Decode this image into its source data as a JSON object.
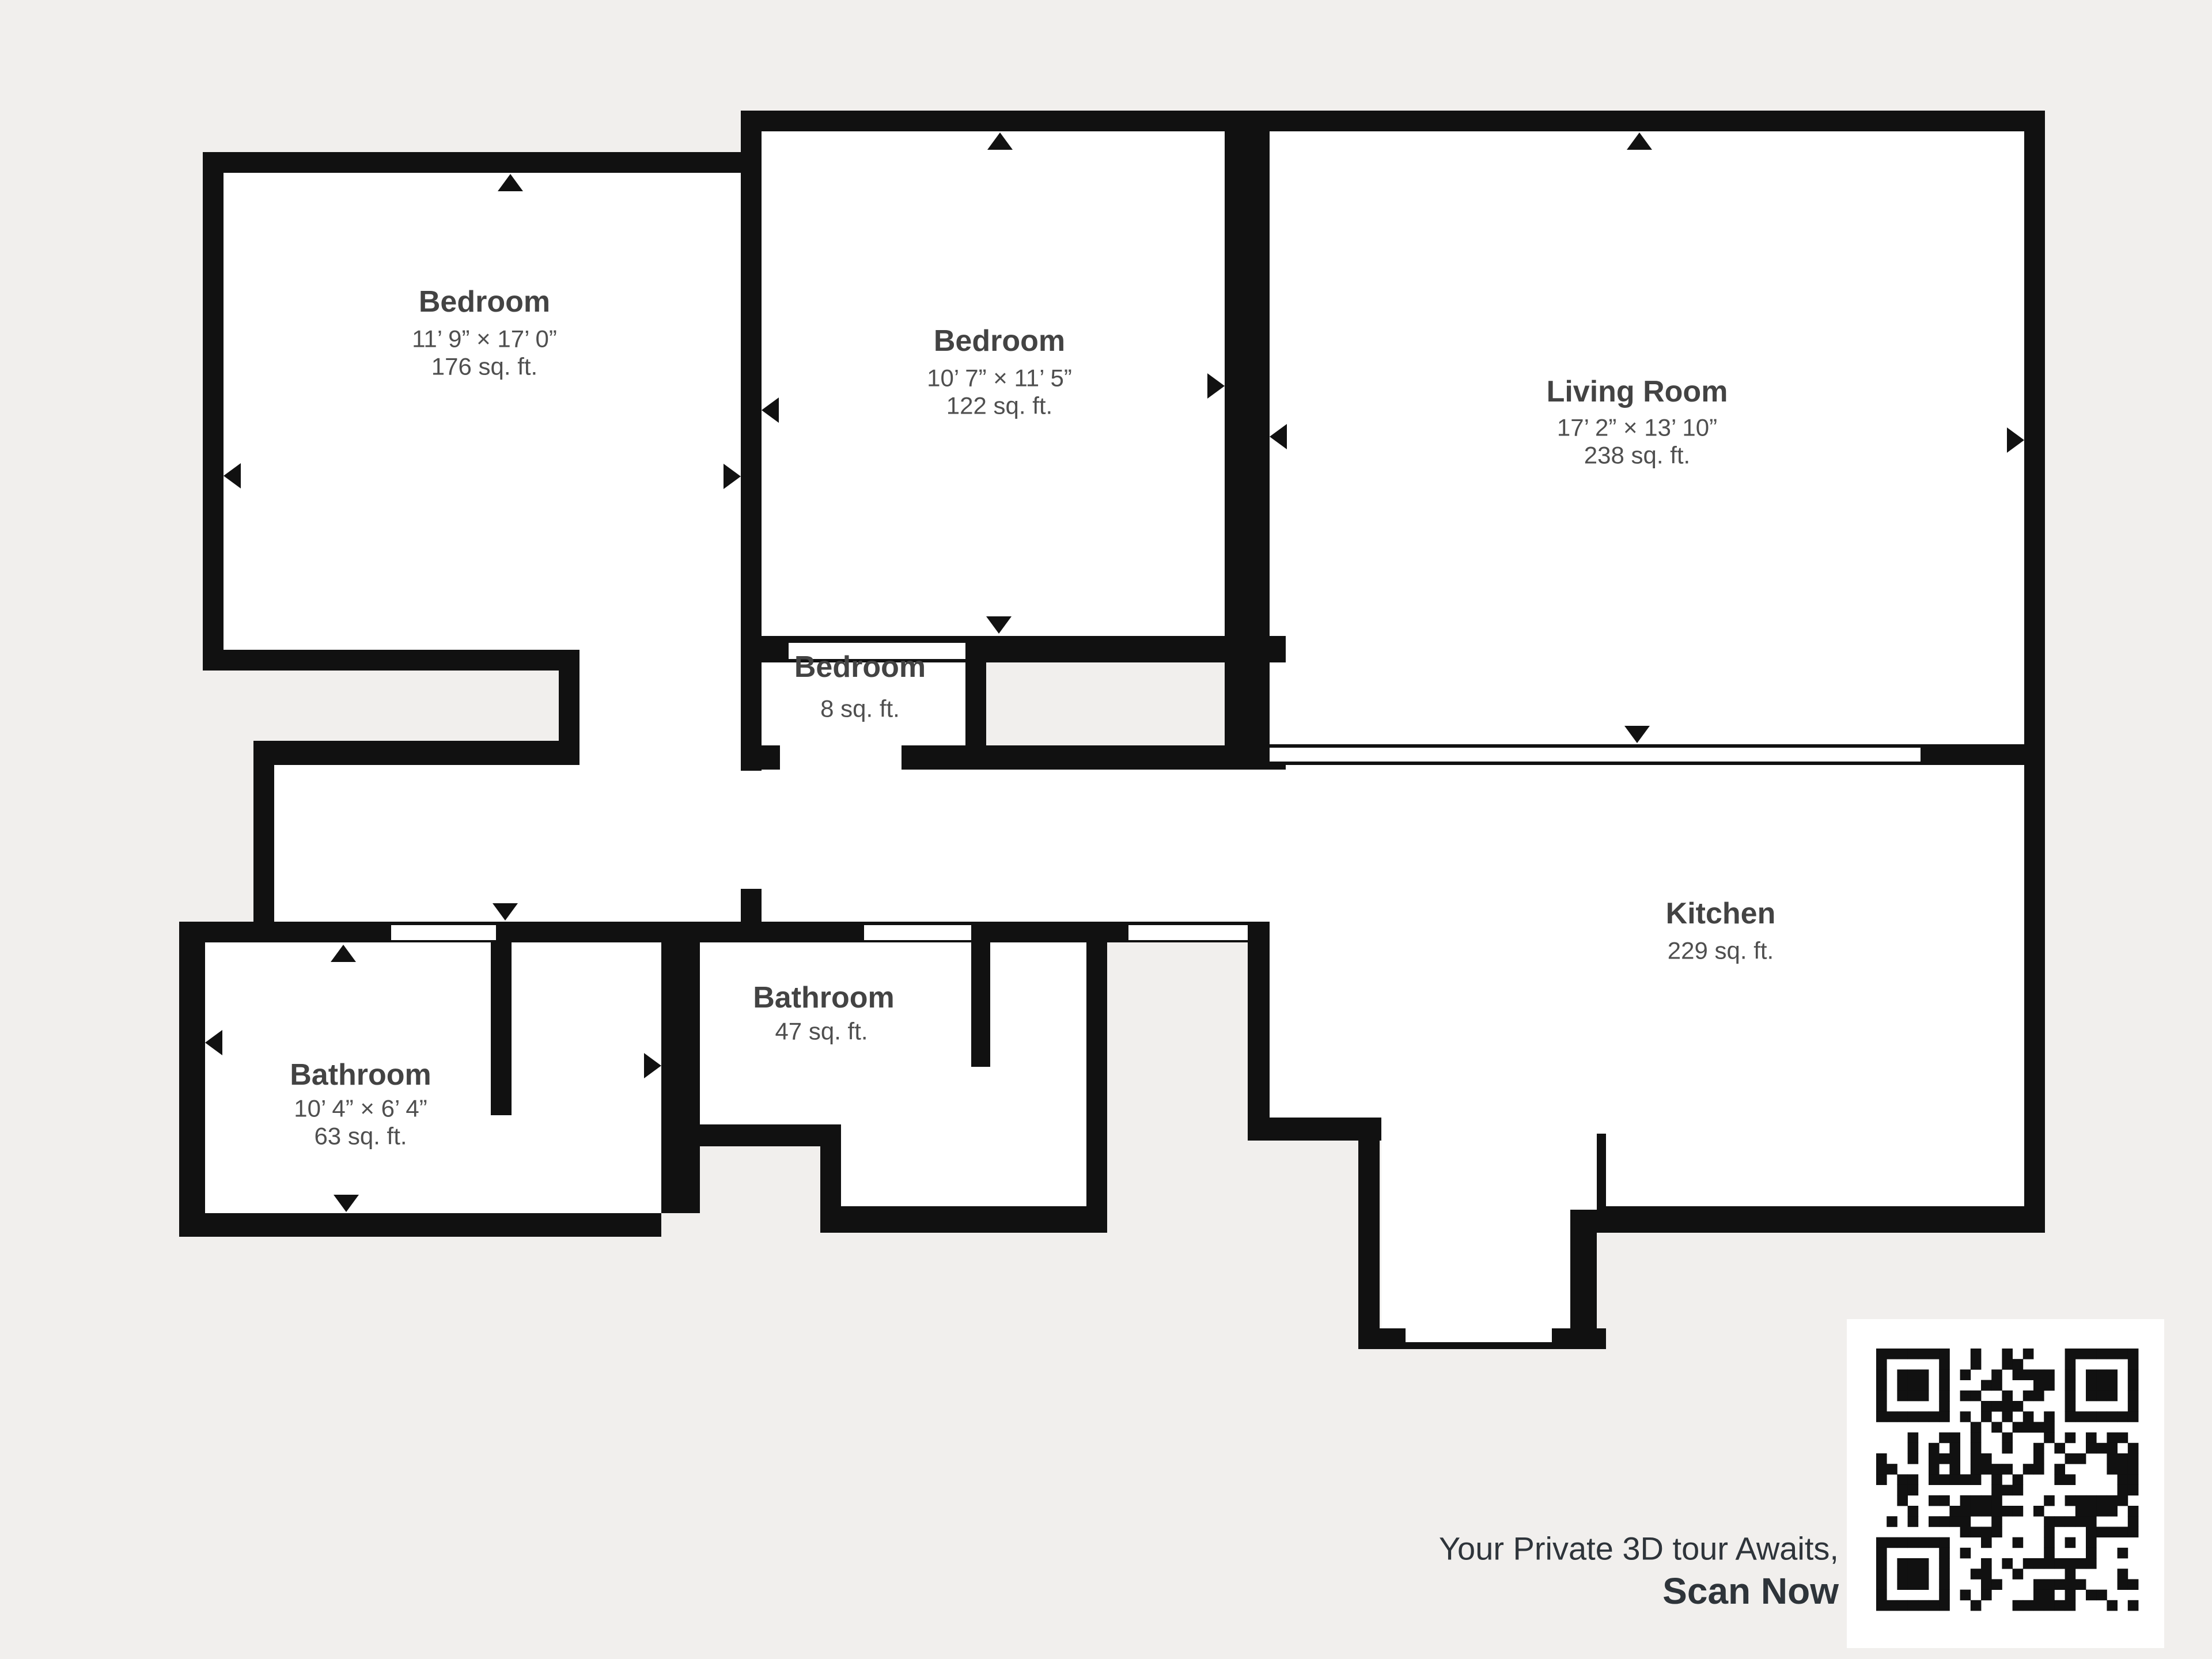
{
  "plan": {
    "rooms": {
      "bedroom_left": {
        "name": "Bedroom",
        "dims": "11’ 9” × 17’ 0”",
        "area": "176 sq. ft."
      },
      "bedroom_middle": {
        "name": "Bedroom",
        "dims": "10’ 7” × 11’ 5”",
        "area": "122 sq. ft."
      },
      "living_room": {
        "name": "Living Room",
        "dims": "17’ 2” × 13’ 10”",
        "area": "238 sq. ft."
      },
      "closet": {
        "name": "Bedroom",
        "area": "8 sq. ft."
      },
      "kitchen": {
        "name": "Kitchen",
        "area": "229 sq. ft."
      },
      "bathroom_left": {
        "name": "Bathroom",
        "dims": "10’ 4” × 6’ 4”",
        "area": "63 sq. ft."
      },
      "bathroom_middle": {
        "name": "Bathroom",
        "area": "47 sq. ft."
      }
    }
  },
  "cta": {
    "line1": "Your Private 3D tour Awaits,",
    "line2": "Scan Now"
  },
  "icons": {
    "qr_code": "qr-code-icon",
    "direction_arrow": "triangle-arrow-icon"
  },
  "colors": {
    "background": "#f1efed",
    "wall": "#111111",
    "room_fill": "#ffffff",
    "label_title": "#434343",
    "label_sub": "#4f4f4f",
    "cta_text": "#2e343a"
  }
}
